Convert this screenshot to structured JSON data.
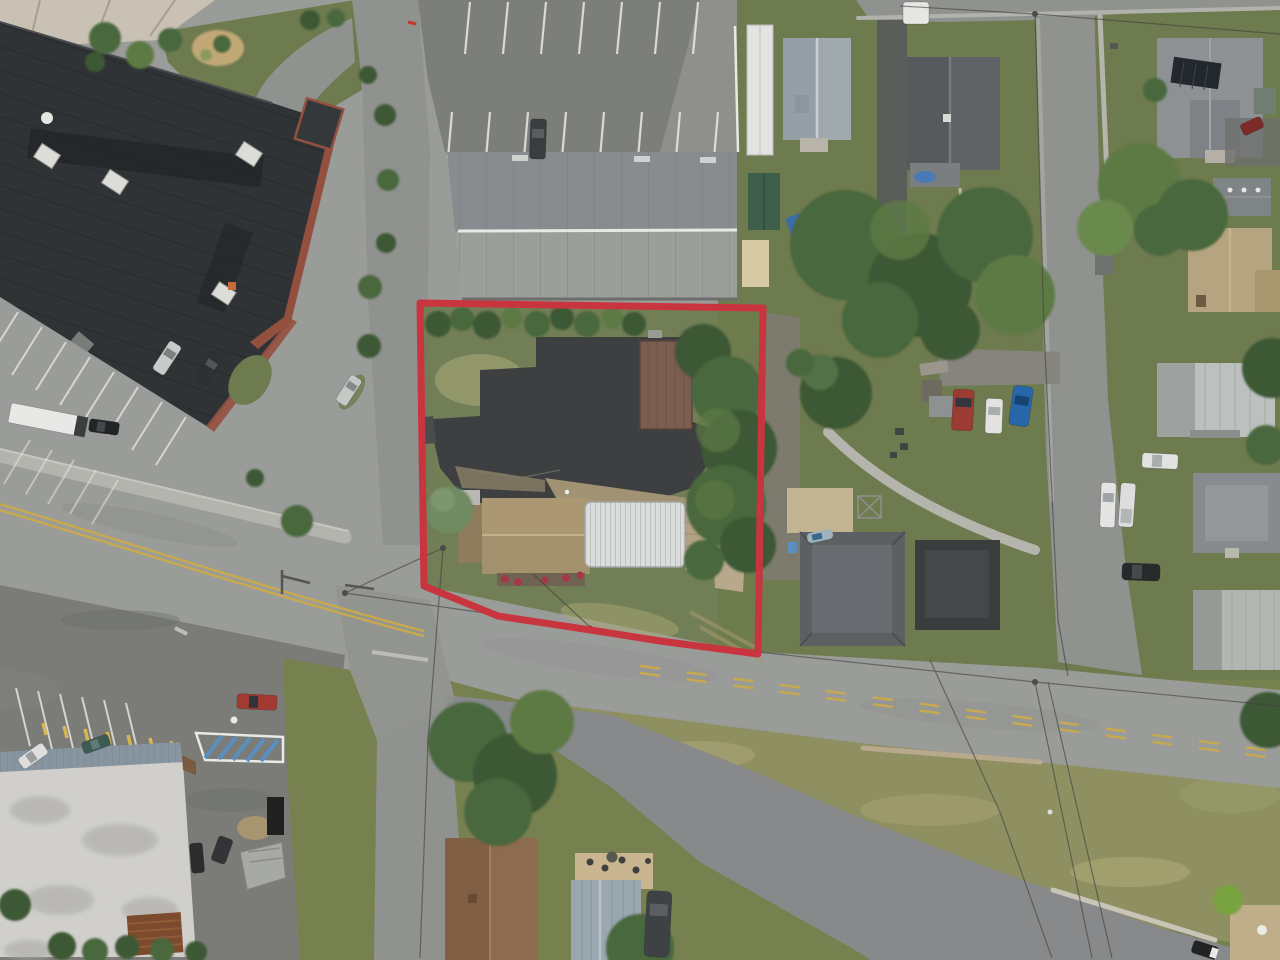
{
  "image": {
    "kind": "aerial-drone-photograph",
    "subject": "Commercial corner property outlined in red at a street intersection, surrounded by commercial buildings, parking lots and residential houses",
    "width_px": 1280,
    "height_px": 960
  },
  "palette": {
    "boundary_red": "#c9353f",
    "road": "#9a9c99",
    "road_new": "#87898b",
    "road_minor": "#90928f",
    "lot": "#7b7c78",
    "lot_light": "#8f908d",
    "lot_dark": "#6e6f6c",
    "asphalt_dark": "#3d3f41",
    "concrete": "#b4b4ae",
    "grass": "#6e7b4e",
    "grass_bottom": "#77814f",
    "grass_dry": "#8f9062",
    "grass_patch": "#a9a878",
    "tree": "#4a673c",
    "tree_dark": "#3c5834",
    "tree_light": "#5d7a45",
    "tree_blue": "#6f8a62",
    "roof_commercial": "#303335",
    "brick": "#94503f",
    "roof_warehouse_n": "#898c8e",
    "roof_warehouse_s": "#9b9e9a",
    "roof_brown": "#7b5e50",
    "roof_tan": "#a3906c",
    "quonset": "#dadddb",
    "deck": "#b3a184",
    "roof_silver": "#bcc0be",
    "roof_blue_gray": "#9fa9ae",
    "roof_dark": "#606366",
    "roof_black": "#3a3c3e",
    "white_building": "#d0cfcb",
    "metal_blue": "#8795a0",
    "rust": "#7c4a2c",
    "yellow_line": "#c9a94e",
    "white_line": "#e9e9e5",
    "mulch": "#c2a877",
    "gravel": "#7d7b72",
    "wire": "#3f3f3d",
    "blue_paint": "#5a8fc0",
    "pool_blue": "#4a7ab5",
    "bush_bright": "#79a33f"
  },
  "boundary": {
    "color": "#c9353f",
    "stroke_width": "7",
    "points": "420,303 763,308 758,654 660,641 597,631 498,616 424,586"
  },
  "scene": {
    "roads": [
      "main-road-diagonal",
      "side-street-south",
      "entrance-drive-north",
      "residential-street-east",
      "new-paved-road-southeast",
      "street-top-east"
    ],
    "road_markings": [
      "double-yellow-centerline-west",
      "dashed-yellow-centerline-east",
      "white-parking-stripes",
      "blue-hatched-no-park-zone",
      "handicap-symbol"
    ],
    "buildings": [
      "commercial-flat-roof-building-with-hvac-units",
      "long-gray-gable-warehouse",
      "brown-metal-garage-on-property",
      "tan-shingle-house-on-property",
      "white-corrugated-quonset-building",
      "white-flat-roof-building-southwest",
      "blue-gray-cross-gable-house",
      "dark-gray-gable-house",
      "large-gray-house-with-solar-panel",
      "gray-garage-shed",
      "tan-gable-house-northeast",
      "silver-metal-roof-house",
      "gray-hip-roof-house",
      "silver-metal-roof-house-south",
      "dark-hip-roof-house",
      "black-roof-house",
      "brown-roof-house-bottom",
      "metal-roof-house-bottom-with-patio",
      "green-shed",
      "tan-canopy",
      "white-camper",
      "small-gray-shed",
      "collapsed-shed"
    ],
    "vehicles": [
      "silver-car-lot",
      "black-suv-lot",
      "silver-car-island",
      "white-box-trailer",
      "black-car-lot",
      "white-car-sw-lot",
      "teal-car-sw-lot",
      "red-pickup-sw-lot",
      "dark-car-rear-lot-1",
      "dark-car-rear-lot-2",
      "dumpster",
      "dark-car-top-lot",
      "white-van-top-street",
      "red-pickup-backyard",
      "white-suv-backyard",
      "blue-car-backyard",
      "white-pickup-street-1",
      "white-pickup-street-2",
      "white-sedan-street",
      "dark-suv-street",
      "dark-suv-bottom-driveway",
      "dark-red-car-driveway",
      "dark-car-new-road",
      "small-boat"
    ],
    "vegetation": [
      "property-hedge-row",
      "large-conifer-cluster",
      "backyard-tree-canopy",
      "street-tree-canopy",
      "landscape-bushes",
      "lawn-areas",
      "grass-embankment"
    ],
    "infrastructure": [
      "power-lines",
      "utility-poles",
      "sidewalks",
      "curb-walls",
      "yellow-bollards",
      "white-picket-fence"
    ]
  }
}
